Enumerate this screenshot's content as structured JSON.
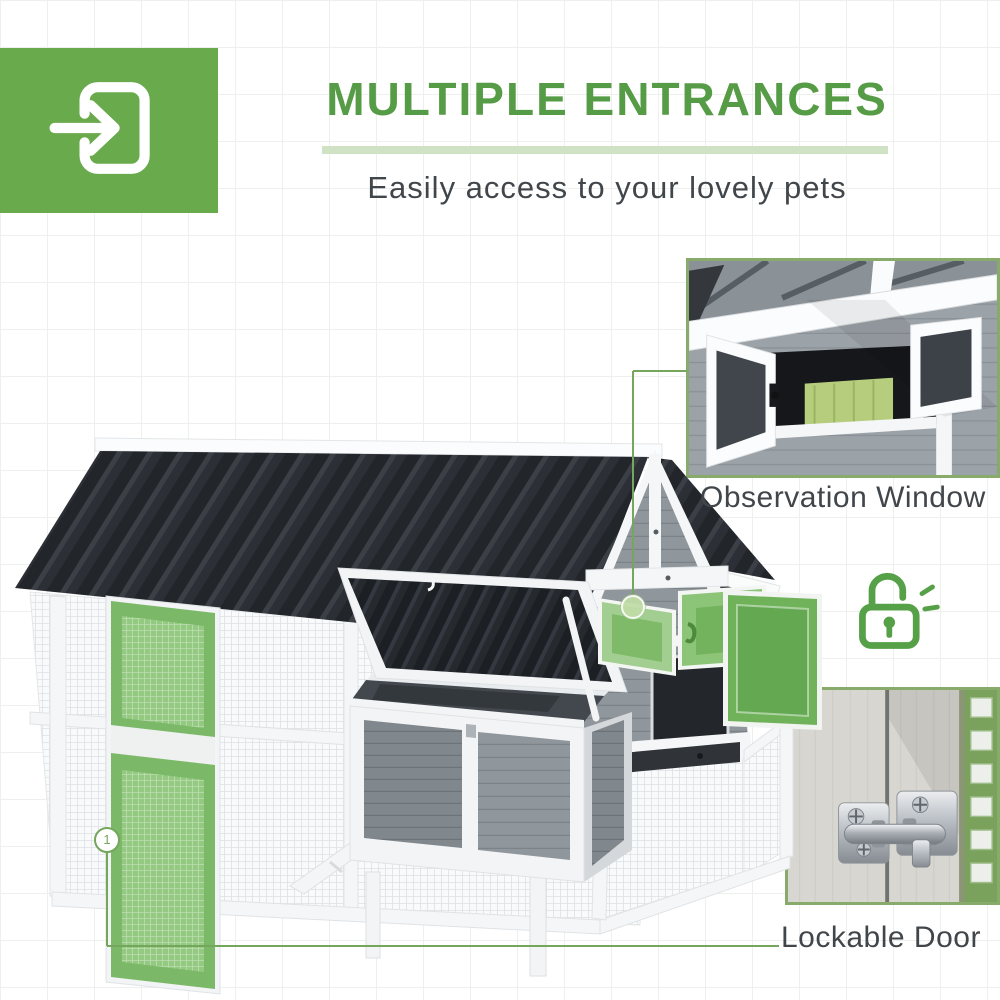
{
  "header": {
    "title": "MULTIPLE ENTRANCES",
    "subtitle": "Easily access to your lovely pets"
  },
  "callouts": {
    "observation_window": {
      "label": "Observation Window"
    },
    "lockable_door": {
      "label": "Lockable Door",
      "marker_number": "1"
    }
  },
  "icons": {
    "entrance_icon": "door-enter-arrow-icon",
    "padlock_icon": "unlocked-padlock-icon"
  },
  "colors": {
    "accent_green": "#569b45",
    "icon_block_green": "#69aa4c",
    "underline_green": "#cfe2c3",
    "leader_line_green": "#74a65c",
    "inset_border_green": "#88ab6c",
    "label_text": "#41464b",
    "roof_charcoal": "#2c3036",
    "door_green": "#7cb969",
    "siding_gray": "#9aa1a7"
  },
  "figure": {
    "main": "chicken-coop-product-illustration",
    "inset_top_right": "observation-window-open-photo",
    "inset_bottom_right": "door-latch-closeup-photo"
  }
}
